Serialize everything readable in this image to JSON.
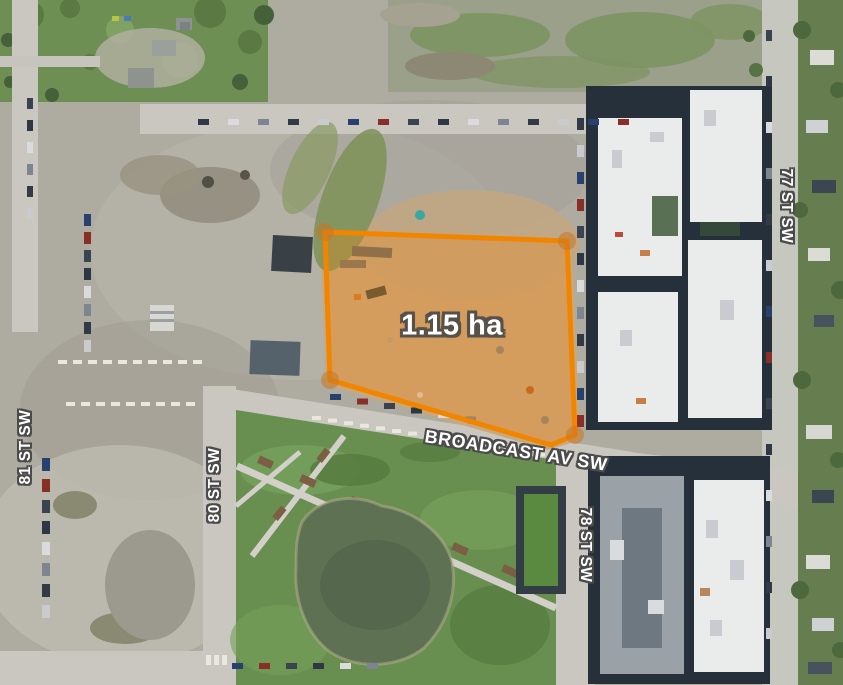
{
  "map": {
    "parcel": {
      "area_label": "1.15 ha",
      "area_ha": 1.15,
      "points_str": "325,232 567,241 575,435 551,445 330,380",
      "vertices": [
        {
          "x": 325,
          "y": 232
        },
        {
          "x": 567,
          "y": 241
        },
        {
          "x": 575,
          "y": 435
        },
        {
          "x": 330,
          "y": 380
        }
      ],
      "outline_hex": "#F28500",
      "fill_rgba": "rgba(243,130,10,0.27)",
      "vertex_rgba": "rgba(198,118,35,0.55)"
    },
    "streets": {
      "broadcast": "BROADCAST AV SW",
      "st77": "77 ST SW",
      "st78": "78 ST SW",
      "st80": "80 ST SW",
      "st81": "81 ST SW"
    },
    "label_colors": {
      "text": "#FFFFFF",
      "street_outline": "#4B4B4B",
      "area_outline": "#57514A"
    }
  }
}
